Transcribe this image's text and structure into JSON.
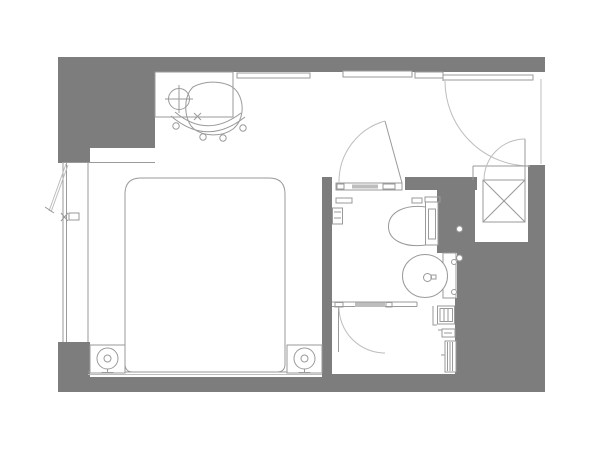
{
  "document": {
    "type": "architectural-floor-plan",
    "title": "Hotel guest room floor plan",
    "visible_text": []
  },
  "colors": {
    "wall": "#7d7d7d",
    "line": "#9a9a9a",
    "line_light": "#bdbdbd",
    "background": "#ffffff"
  },
  "rooms": [
    {
      "name": "bedroom",
      "elements": [
        "double-bed",
        "headboard-ledge",
        "nightstand-left",
        "nightstand-right",
        "table-lamp-left",
        "table-lamp-right",
        "desk",
        "desk-lamp",
        "office-chair",
        "casement-window",
        "wall-mounted-panels"
      ]
    },
    {
      "name": "entry-vestibule",
      "elements": [
        "entry-door",
        "closet",
        "closet-door"
      ]
    },
    {
      "name": "bathroom",
      "elements": [
        "bathroom-door",
        "toilet",
        "washbasin",
        "vanity-counter",
        "faucet",
        "toilet-paper-holder",
        "wall-hooks",
        "shower-partition",
        "shower-door",
        "shelf-unit",
        "soap-dish",
        "towel-radiator"
      ]
    }
  ]
}
